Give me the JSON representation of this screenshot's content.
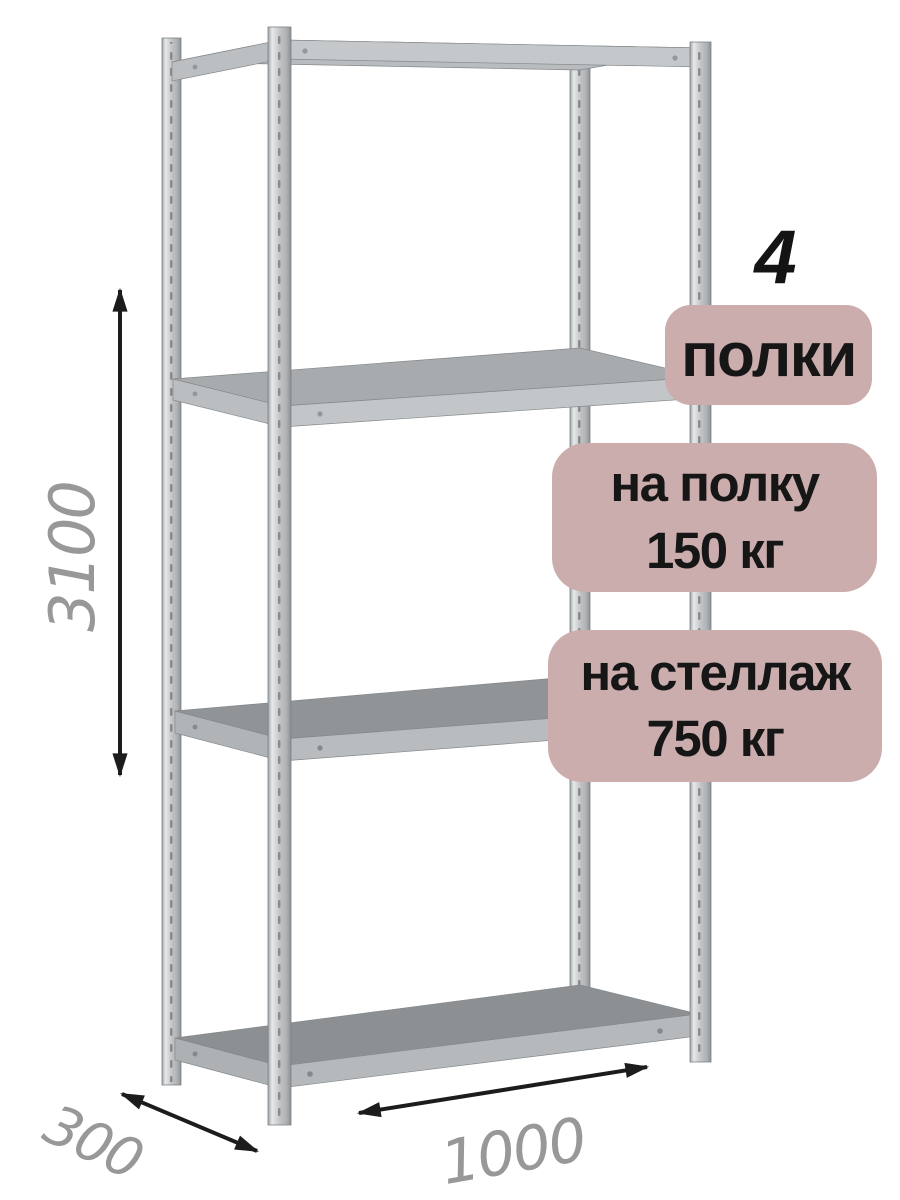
{
  "illustration": {
    "subject": "metal-shelving-rack",
    "dimensions": {
      "height_mm": "3100",
      "depth_mm": "300",
      "width_mm": "1000"
    },
    "callouts": {
      "count": "4",
      "count_label": "полки",
      "per_shelf": {
        "line1": "на полку",
        "line2": "150 кг"
      },
      "per_rack": {
        "line1": "на стеллаж",
        "line2": "750 кг"
      }
    },
    "colors": {
      "badge_bg": "#cbadae",
      "badge_text": "#161616",
      "dimension_text": "#989898",
      "arrow": "#1c1c1c",
      "metal_light": "#e7e9ea",
      "metal_mid": "#c3c6c8",
      "metal_dark": "#8c9092",
      "background": "#ffffff"
    }
  }
}
